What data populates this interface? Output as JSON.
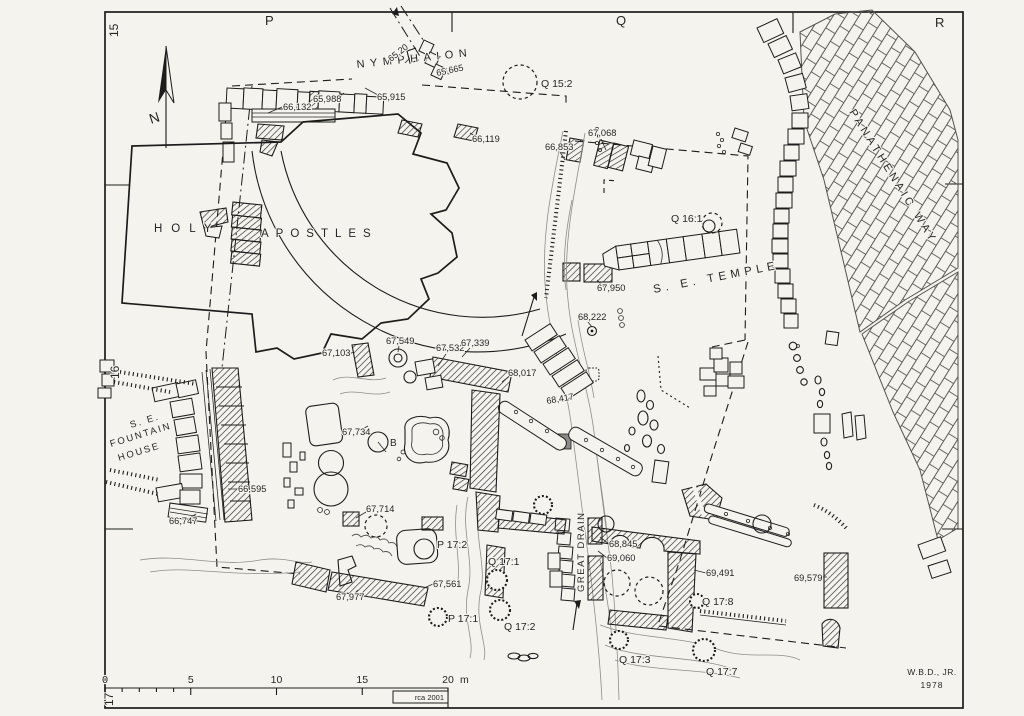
{
  "map": {
    "grid_labels": [
      {
        "t": "P",
        "x": 265,
        "y": 25,
        "s": 13,
        "ls": 1
      },
      {
        "t": "Q",
        "x": 616,
        "y": 25,
        "s": 13,
        "ls": 1
      },
      {
        "t": "R",
        "x": 935,
        "y": 27,
        "s": 13,
        "ls": 1
      },
      {
        "t": "15",
        "x": 118,
        "y": 37,
        "s": 12,
        "r": -90
      },
      {
        "t": "16",
        "x": 119,
        "y": 379,
        "s": 12,
        "r": -90
      },
      {
        "t": "17",
        "x": 113,
        "y": 706,
        "s": 12,
        "r": -90
      }
    ],
    "area_labels": [
      {
        "t": "NYMPHAION",
        "x": 357,
        "y": 68,
        "s": 11,
        "ls": 5.5,
        "r": -6
      },
      {
        "t": "HOLY",
        "x": 154,
        "y": 232,
        "s": 11.5,
        "ls": 9
      },
      {
        "t": "APOSTLES",
        "x": 261,
        "y": 237,
        "s": 11.5,
        "ls": 7
      },
      {
        "t": "S. E. TEMPLE",
        "x": 654,
        "y": 293,
        "s": 11.5,
        "ls": 4.5,
        "r": -11
      },
      {
        "t": "PANATHENAIC WAY",
        "x": 849,
        "y": 112,
        "s": 11,
        "ls": 3.5,
        "r": 58
      },
      {
        "t": "S. E.",
        "x": 131,
        "y": 428,
        "s": 9.5,
        "ls": 2,
        "r": -17
      },
      {
        "t": "FOUNTAIN",
        "x": 111,
        "y": 447,
        "s": 9.5,
        "ls": 2,
        "r": -17
      },
      {
        "t": "HOUSE",
        "x": 119,
        "y": 461,
        "s": 9.5,
        "ls": 2,
        "r": -17
      },
      {
        "t": "GREAT DRAIN",
        "x": 584,
        "y": 592,
        "s": 9.5,
        "ls": 1.5,
        "r": -90
      },
      {
        "t": "N",
        "x": 151,
        "y": 124,
        "s": 14,
        "r": -18
      },
      {
        "t": "B",
        "x": 390,
        "y": 446,
        "s": 10
      }
    ],
    "point_labels": [
      {
        "t": "Q 15:2",
        "x": 541,
        "y": 87,
        "s": 10.5
      },
      {
        "t": "Q 16:1",
        "x": 671,
        "y": 222,
        "s": 10.5
      },
      {
        "t": "P 17:2",
        "x": 437,
        "y": 548,
        "s": 10.5
      },
      {
        "t": "Q 17:1",
        "x": 488,
        "y": 565,
        "s": 10.5
      },
      {
        "t": "P 17:1",
        "x": 448,
        "y": 622,
        "s": 10.5
      },
      {
        "t": "Q 17:2",
        "x": 504,
        "y": 630,
        "s": 10.5
      },
      {
        "t": "Q 17:3",
        "x": 619,
        "y": 663,
        "s": 10.5
      },
      {
        "t": "Q 17:7",
        "x": 706,
        "y": 675,
        "s": 10.5
      },
      {
        "t": "Q 17:8",
        "x": 702,
        "y": 605,
        "s": 10.5
      }
    ],
    "elevation_labels": [
      {
        "t": "65,20",
        "x": 391,
        "y": 62,
        "s": 9,
        "r": -38
      },
      {
        "t": "65,665",
        "x": 437,
        "y": 76,
        "s": 9,
        "r": -12
      },
      {
        "t": "65,988",
        "x": 313,
        "y": 102,
        "s": 9.3
      },
      {
        "t": "65,915",
        "x": 377,
        "y": 100,
        "s": 9.3
      },
      {
        "t": "66,132",
        "x": 283,
        "y": 110,
        "s": 9.3
      },
      {
        "t": "66,119",
        "x": 472,
        "y": 142,
        "s": 9.3
      },
      {
        "t": "66,853",
        "x": 545,
        "y": 150,
        "s": 9.3
      },
      {
        "t": "67,068",
        "x": 588,
        "y": 136,
        "s": 9.3
      },
      {
        "t": "67,950",
        "x": 597,
        "y": 291,
        "s": 9.3
      },
      {
        "t": "68,222",
        "x": 578,
        "y": 320,
        "s": 9.3
      },
      {
        "t": "67,549",
        "x": 386,
        "y": 344,
        "s": 9.3
      },
      {
        "t": "67,103",
        "x": 322,
        "y": 356,
        "s": 9.3
      },
      {
        "t": "67,532",
        "x": 436,
        "y": 351,
        "s": 9.3
      },
      {
        "t": "67,339",
        "x": 461,
        "y": 346,
        "s": 9.3
      },
      {
        "t": "68,017",
        "x": 508,
        "y": 376,
        "s": 9.3
      },
      {
        "t": "68,417",
        "x": 547,
        "y": 404,
        "s": 9,
        "r": -10
      },
      {
        "t": "67,734",
        "x": 342,
        "y": 435,
        "s": 9.3
      },
      {
        "t": "66,595",
        "x": 238,
        "y": 492,
        "s": 9.3
      },
      {
        "t": "66,747",
        "x": 169,
        "y": 524,
        "s": 9.3
      },
      {
        "t": "67,714",
        "x": 366,
        "y": 512,
        "s": 9.3
      },
      {
        "t": "67,561",
        "x": 433,
        "y": 587,
        "s": 9.3
      },
      {
        "t": "67,977",
        "x": 336,
        "y": 600,
        "s": 9.3
      },
      {
        "t": "68,845",
        "x": 609,
        "y": 547,
        "s": 9.3
      },
      {
        "t": "69,060",
        "x": 607,
        "y": 561,
        "s": 9.3
      },
      {
        "t": "69,491",
        "x": 706,
        "y": 576,
        "s": 9.3
      },
      {
        "t": "69,579",
        "x": 794,
        "y": 581,
        "s": 9.3
      }
    ],
    "scale_bar": {
      "ticks": [
        "0",
        "5",
        "10",
        "15",
        "20"
      ],
      "unit": "m",
      "x0": 105,
      "x1": 448,
      "y": 688
    },
    "credits": {
      "drafter": "rca 2001",
      "author": "W.B.D., JR.",
      "year": "1978"
    }
  }
}
